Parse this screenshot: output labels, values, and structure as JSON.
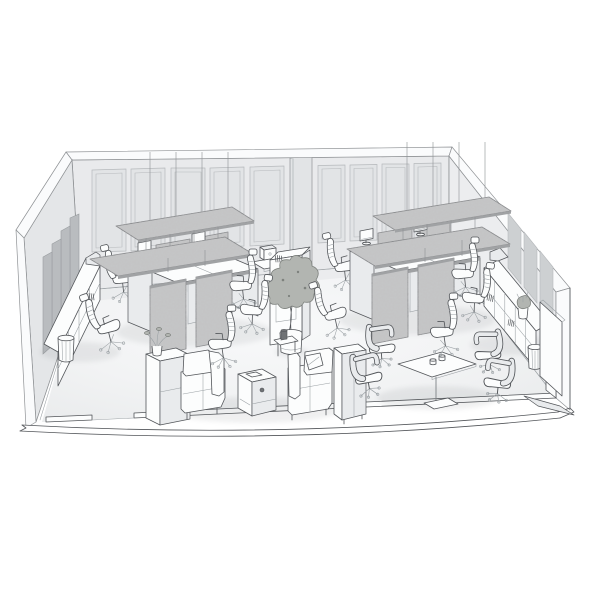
{
  "scene": {
    "kind": "isometric-3d-office-cutaway-render",
    "style": "monochrome-line-architectural-visualization",
    "room": {
      "walls": [
        "back-paneled-wall",
        "left-wall",
        "right-wall",
        "front-cutaway-baseboard"
      ],
      "door_openings": 1,
      "back_wall_molding_panels": 9,
      "back_wall_pillar": 1,
      "acoustic_panels_left_wall": 4,
      "acoustic_panels_right_wall": 3
    },
    "objects": [
      {
        "name": "suspended-acoustic-baffle",
        "count": 4
      },
      {
        "name": "hanging-wire",
        "count": 8
      },
      {
        "name": "desk-pod",
        "count": 2,
        "desks_per_pod": 4
      },
      {
        "name": "desk-privacy-screen",
        "count": 4
      },
      {
        "name": "desk-divider-screen",
        "count": 4
      },
      {
        "name": "desktop-monitor",
        "count": 4
      },
      {
        "name": "laptop",
        "count": 2
      },
      {
        "name": "paper-sheet",
        "count": 4
      },
      {
        "name": "task-chair",
        "count": 10
      },
      {
        "name": "meeting-armchair",
        "count": 4
      },
      {
        "name": "meeting-table",
        "count": 1
      },
      {
        "name": "cup",
        "count": 2
      },
      {
        "name": "sofa",
        "count": 2
      },
      {
        "name": "throw-pillow",
        "count": 1
      },
      {
        "name": "coffee-table",
        "count": 1
      },
      {
        "name": "lounge-side-table",
        "count": 1
      },
      {
        "name": "lounge-tall-cabinet",
        "count": 1
      },
      {
        "name": "sideboard",
        "count": 1
      },
      {
        "name": "open-shelving-unit",
        "count": 2
      },
      {
        "name": "storage-partition-cabinet",
        "count": 1
      },
      {
        "name": "console-table",
        "count": 1
      },
      {
        "name": "coffee-machine",
        "count": 1
      },
      {
        "name": "potted-tree",
        "count": 1
      },
      {
        "name": "small-plant",
        "count": 2
      },
      {
        "name": "waste-basket",
        "count": 2
      },
      {
        "name": "mobile-whiteboard",
        "count": 1
      }
    ]
  },
  "theme": {
    "line": "#53565a",
    "line2": "#9aa0a4",
    "white": "#fcfdfd",
    "side": "#e9ebed",
    "wall": "#e9eaec",
    "wallL": "#e4e6e8",
    "wallR": "#ecedef",
    "band": "#fafbfc",
    "wline": "#8f9295",
    "panel": "#e2e4e6",
    "pline": "#b6b9bc",
    "apanelL": "#b9bcbf",
    "apline": "#999da0",
    "apanelR": "#cdd0d2",
    "fabric": "#c6c7c8",
    "fline": "#77797c",
    "fedge": "#a0a2a4",
    "shadow": "#565b60",
    "wire": "#8d9093",
    "foliage": "#b2b5b1",
    "folline": "#7d817d",
    "darkobj": "#6f7275",
    "background": "#ffffff"
  }
}
